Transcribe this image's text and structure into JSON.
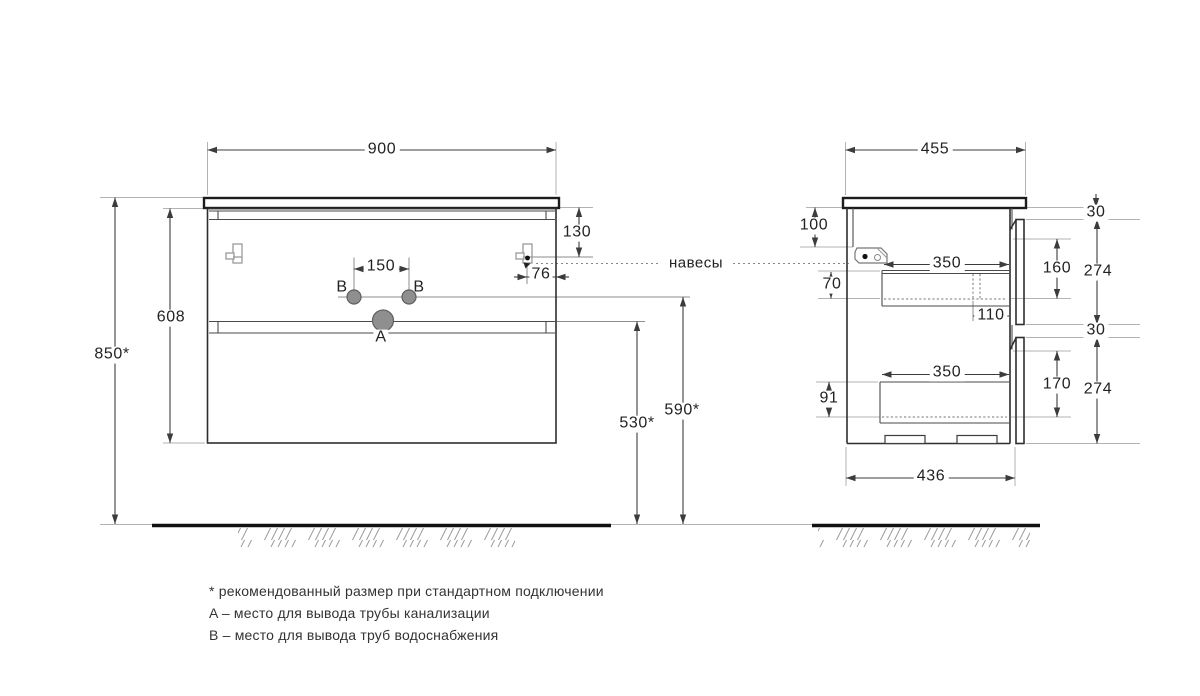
{
  "callouts": {
    "hangers": "навесы",
    "point_a": "A",
    "point_b": "B"
  },
  "front": {
    "width": "900",
    "overall_height": "850*",
    "cabinet_height": "608",
    "hanger_top_offset": "130",
    "hanger_side_inset": "76",
    "supply_spacing": "150",
    "drain_outlet_height": "530*",
    "supply_outlet_height": "590*"
  },
  "side": {
    "depth": "455",
    "back_rail_height": "100",
    "top_gap": "30",
    "mid_gap": "30",
    "drawer1_top_inset": "70",
    "drawer1_depth": "350",
    "drawer1_back_gap": "110",
    "drawer1_inner_height": "160",
    "drawer1_front_height": "274",
    "drawer2_top_inset": "91",
    "drawer2_depth": "350",
    "drawer2_inner_height": "170",
    "drawer2_front_height": "274",
    "bottom_depth": "436"
  },
  "notes": {
    "recommended": "* рекомендованный размер при стандартном подключении",
    "point_a": "A – место для вывода трубы канализации",
    "point_b": "B – место для вывода труб водоснабжения"
  },
  "colors": {
    "line": "#2e2e2e",
    "dimension": "#3c3c3c",
    "extension": "#b3b3b3",
    "point_fill": "#8f8f8f"
  }
}
